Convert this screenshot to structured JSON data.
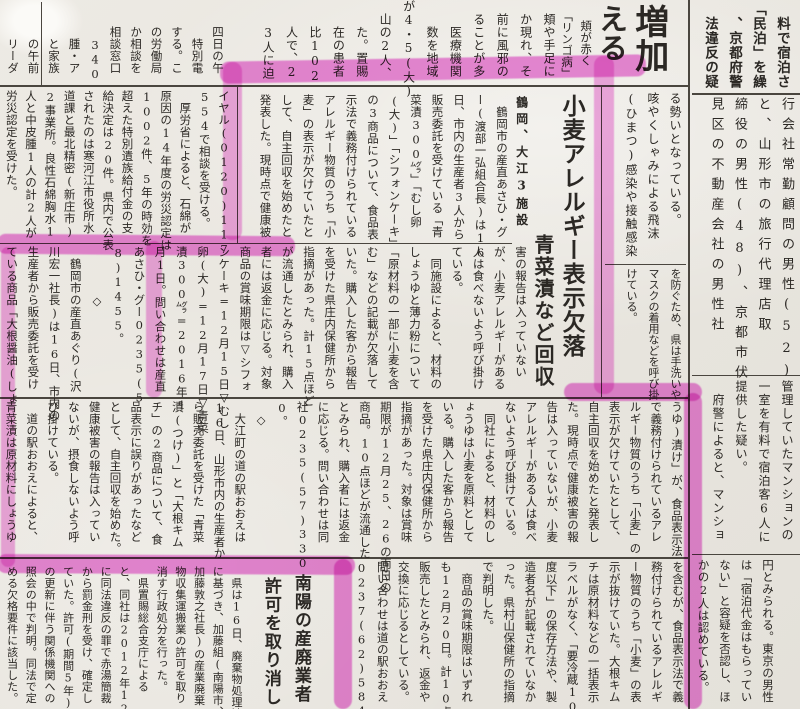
{
  "colors": {
    "highlighter": "#e23cc8",
    "paper": "#eae7e1",
    "ink": "#2b2824"
  },
  "top_left_fragments": {
    "columns": [
      "　　四日の午",
      "　　　特別電",
      "　　する。こ",
      "　　の労働局",
      "　　か相談を",
      "　　相談窓口",
      "　　　340",
      "　　　腫・ア",
      "　　　と家族",
      "　　　の午前",
      "　　　リーダ"
    ]
  },
  "top_mid_fragments": {
    "columns": [
      "　頬や手足に",
      "　か現れ、そ",
      "　前に風邪の",
      "　ることが多",
      "　　医療機関",
      "　　数を地域",
      "が4・5(大)",
      "　山の2人、",
      "　　た。置賜",
      "　　在の患者",
      "　　比102",
      "　　人で、2",
      "　　3人に迫"
    ]
  },
  "increase_block": {
    "headline_main": "増加",
    "headline_partial": "える",
    "kicker_small": "頬が赤く",
    "kicker_quote": "「リンゴ病」",
    "body_band1": [
      "る勢いとなっている。",
      "咳やくしゃみによる飛沫",
      "(ひまつ)感染や接触感染"
    ],
    "body_band2": [
      "を防ぐため、県は手洗いや",
      "マスクの着用などを呼び掛",
      "けている。"
    ]
  },
  "minpaku_article": {
    "top_fragments": [
      "　料で宿泊さ",
      "「民泊」を繰",
      "　、京都府警",
      "　法違反の疑"
    ],
    "band1": [
      "行会社常勤顧問の男性(52)",
      "と、山形市の旅行代理店取",
      "締役の男性(48)、京都市伏",
      "見区の不動産会社の男性社"
    ],
    "band2": [
      "管理していたマンションの",
      "一室を有料で宿泊客6人に",
      "提供した疑い。",
      "　府警によると、マンショ"
    ],
    "band3": [
      "円とみられる。東京の男性",
      "は「宿泊代金はもらってい",
      "ない」と容疑を否認し、ほ",
      "かの2人は認めている。"
    ]
  },
  "asbestos_article": {
    "columns": [
      "イヤル(0120)117",
      "554で相談を受ける。",
      "　厚労省によると、石綿が",
      "原因の14年度の労災認定は",
      "1002件、5年の時効を",
      "超えた特別遺族給付金の支",
      "給決定は20件。県内で公表",
      "されたのは寒河江市役所水",
      "道課と最北精密(新庄市)",
      "2事業所。良性石綿胸水1",
      "人と中皮腫1人の計2人が",
      "労災認定を受けた。"
    ]
  },
  "wheat_article": {
    "kicker": "鶴岡、大江3施設",
    "subhead": "青菜漬など回収",
    "headline": "小麦アレルギー表示欠落",
    "band1": [
      "　鶴岡市の産直あさひ・グ",
      "ー(渡部一弘組合長)は16",
      "日、市内の生産者3人から",
      "販売委託を受けている「青",
      "菜漬300㌘」「むし卵",
      "(大)」「シフォンケーキ」",
      "の3商品について、食品表",
      "示法で義務付けられている",
      "アレルギー物質のうち「小",
      "麦」の表示が欠けていたと",
      "して、自主回収を始めたと",
      "発表した。現時点で健康被"
    ],
    "band2": [
      "害の報告は入っていない",
      "が、小麦アレルギーがある",
      "人は食べないよう呼び掛け",
      "ている。",
      "　同施設によると、材料の",
      "しょうゆと薄力粉について",
      "「原材料の一部に小麦を含",
      "む」などの記載が欠落して",
      "いた。購入した客から報告",
      "を受けた県庄内保健所から",
      "指摘があった。計15点ほど",
      "が流通したとみられ、購入",
      "者には返金に応じる。対象",
      "商品の賞味期限は▽シフォ",
      "ンケーキ=12月15日▽むし",
      "卵(大)=12月17日▽青菜",
      "漬300㌘=2016年1",
      "月1日。問い合わせは産直",
      "あさひ・グー0235(5",
      "8)1455。",
      "　　　　◇",
      "　鶴岡市の産直あぐり(沢",
      "川宏一社長)は16日、市内の",
      "生産者から販売委託を受け",
      "ている商品「大根醤油(しょ"
    ],
    "band3": [
      "うゆ)漬け」が、食品表示法",
      "で義務付けられているアレ",
      "ルギー物質のうち「小麦」の",
      "表示が欠けていたとして、",
      "自主回収を始めたと発表し",
      "た。現時点で健康被害の報",
      "告は入っていないが、小麦",
      "アレルギーがある人は食べ",
      "ないよう呼び掛けている。",
      "　同社によると、材料のし",
      "ょうゆは小麦を原料として",
      "いる。購入した客から報告",
      "を受けた県庄内保健所から",
      "指摘があった。対象は賞味",
      "期限が12月25、26の両日の",
      "商品。10点ほどが流通した",
      "とみられ、購入者には返金",
      "に応じる。問い合わせは同",
      "社0235(57)330",
      "0。",
      "　◇",
      "　大江町の道の駅おおえは",
      "16日、山形市内の生産者か",
      "ら販売委託を受けた「青菜",
      "漬(つけ)」と「大根キム",
      "チ」の2商品について、食",
      "品表示に誤りがあったなど",
      "として、自主回収を始めた。",
      "健康被害の報告は入ってい",
      "ないが、摂食しないよう呼",
      "び掛けている。",
      "　道の駅おおえによると、",
      "青菜漬は原材料にしょうゆ"
    ],
    "band4": [
      "を含むが、食品表示法で義",
      "務付けられているアレルギ",
      "ー物質のうち「小麦」の表",
      "示が抜けていた。大根キム",
      "チは原材料などの一括表示",
      "ラベルがなく、「要冷蔵10",
      "度以下」の保存方法や、製",
      "造者名が記載されていなか",
      "った。県村山保健所の指摘",
      "で判明した。",
      "　商品の賞味期限はいずれ",
      "も12月20日。計10点ほどを",
      "販売したとみられ、返金や",
      "交換に応じるとしている。",
      "問い合わせは道の駅おおえ",
      "0237(62)5845。"
    ]
  },
  "nanyo_article": {
    "headline_line1": "南陽の産廃業者",
    "headline_line2": "許可を取り消し",
    "body": [
      "　県は16日、廃棄物処理法",
      "に基づき、加藤組(南陽市、",
      "加藤敦之社長)の産業廃棄",
      "物収集運搬業の許可を取り",
      "消す行政処分を行った。",
      "　県置賜総合支庁による",
      "と、同社は2012年12月",
      "に同法違反の罪で赤湯簡裁",
      "から罰金刑を受け、確定し",
      "ていた。許可(期間5年)",
      "の更新に伴う関係機関への",
      "照会の中で判明。同法で定",
      "める欠格要件に該当した。"
    ]
  }
}
